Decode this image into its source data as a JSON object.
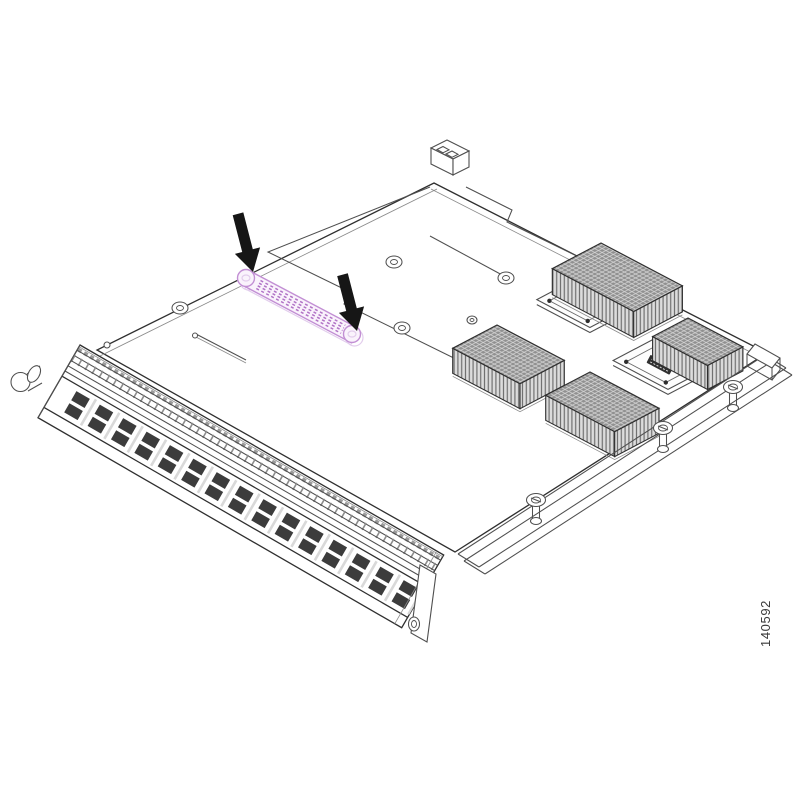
{
  "figure": {
    "number": "140592"
  },
  "colors": {
    "background": "#ffffff",
    "line": "#4f4f4f",
    "line_dark": "#2f2f2f",
    "arrow": "#161616",
    "connector_outline": "#c28fd4",
    "connector_dash": "#b173c6",
    "connector_fill": "#faf3fc",
    "connector_shadow": "#e2cdec",
    "heatsink_top": "#909090",
    "heatsink_hatch": "#d6d6d6",
    "heatsink_side": "#dcdcdc",
    "heatsink_fin": "#6f6f6f",
    "port": "#3c3c3c",
    "figure_text": "#3a3a3a"
  }
}
